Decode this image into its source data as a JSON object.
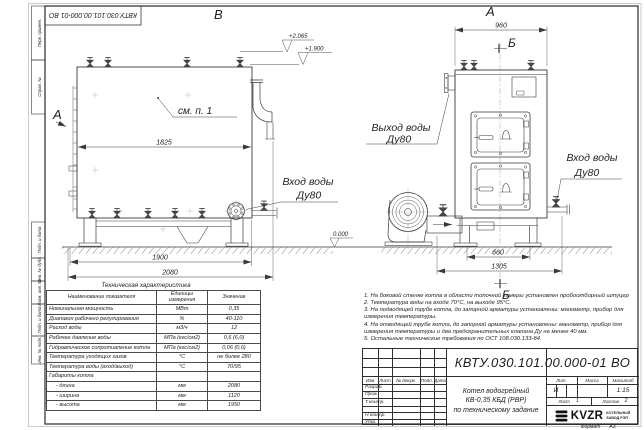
{
  "frame": {
    "top_stamp": "КВТУ.030.101.00.000-01 ВО",
    "left_top_cells": [
      "Перв. примен.",
      "Справ. №"
    ],
    "left_bottom_cells": [
      "Подп. и дата",
      "Инв. № дубл.",
      "Взам. инв. №",
      "Подп. и дата",
      "Инв. № подл."
    ],
    "format_label": "Формат",
    "format_value": "А3"
  },
  "views": {
    "label_b": "В",
    "label_a": "А",
    "label_section": "Б",
    "label_arrow_a": "А",
    "see_note": "см. п. 1",
    "inlet_left": {
      "line1": "Вход воды",
      "line2": "Ду80"
    },
    "outlet": {
      "line1": "Выход воды",
      "line2": "Ду80"
    },
    "inlet_right": {
      "line1": "Вход воды",
      "line2": "Ду80"
    },
    "dims": {
      "d1825": "1825",
      "d1900": "1900",
      "d2080": "2080",
      "d960": "960",
      "d660": "660",
      "d1305": "1305"
    },
    "elevations": {
      "top": "+2.065",
      "mid": "+1.900",
      "zero": "0.000"
    }
  },
  "spec_table": {
    "title": "Техническая характеристика",
    "col_name": "Наименование показателя",
    "col_units": "Единицы измерения",
    "col_value": "Значение",
    "rows": [
      [
        "Номинальная мощность",
        "МВт",
        "0,35"
      ],
      [
        "Диапазон рабочего регулирования",
        "%",
        "40-110"
      ],
      [
        "Расход воды",
        "м3/ч",
        "12"
      ],
      [
        "Рабочее давление воды",
        "МПа (кгс/см2)",
        "0,6 (6,0)"
      ],
      [
        "Гидравлическое сопротивление котла",
        "МПа (кгс/см2)",
        "0,06 (0,6)"
      ],
      [
        "Температура уходящих газов",
        "°С",
        "не более 280"
      ],
      [
        "Температура воды (вход/выход)",
        "°С",
        "70/95"
      ],
      [
        "Габариты котла",
        "",
        ""
      ],
      [
        "- длина",
        "мм",
        "2080"
      ],
      [
        "- ширина",
        "мм",
        "1120"
      ],
      [
        "- высота",
        "мм",
        "1950"
      ]
    ]
  },
  "notes": [
    "1. На боковой стенке котла в области топочной камеры установлен пробоотборный штуцер",
    "2. Температура воды на входе 70°С, на выходе 95°С.",
    "3. На подводящей трубе котла, до запорной арматуры установлены: манометр, прибор для",
    "измерения температуры.",
    "4. На отводящей трубе котла, до запорной арматуры установлены: манометр, прибор для",
    "измерения температуры и два предохранительных клапана Ду не менее 40 мм.",
    "5. Остальные технические требования по ОСТ 108.030.133-84."
  ],
  "title_block": {
    "doc_number": "КВТУ.030.101.00.000-01 ВО",
    "product_line1": "Котел водогрейный",
    "product_line2": "КВ-0,35 КБД (РВР)",
    "product_line3": "по техническому задание",
    "col_izm": "Изм.",
    "col_list": "Лист",
    "col_doc": "№ докум.",
    "col_sign": "Подп.",
    "col_date": "Дата",
    "row_labels": [
      "Разраб.",
      "Пров.",
      "Т.контр.",
      "Н.контр.",
      "Утв."
    ],
    "lit_header": "Лит.",
    "mass_header": "Масса",
    "scale_header": "Масштаб",
    "lit_value": "И",
    "scale_value": "1:15",
    "sheet_label": "Лист",
    "sheet_value": "1",
    "sheets_label": "Листов",
    "sheets_value": "2",
    "brand": "KVZR",
    "brand_line1": "КОТЕЛЬНЫЙ",
    "brand_line2": "ЗАВОД РЭП"
  }
}
